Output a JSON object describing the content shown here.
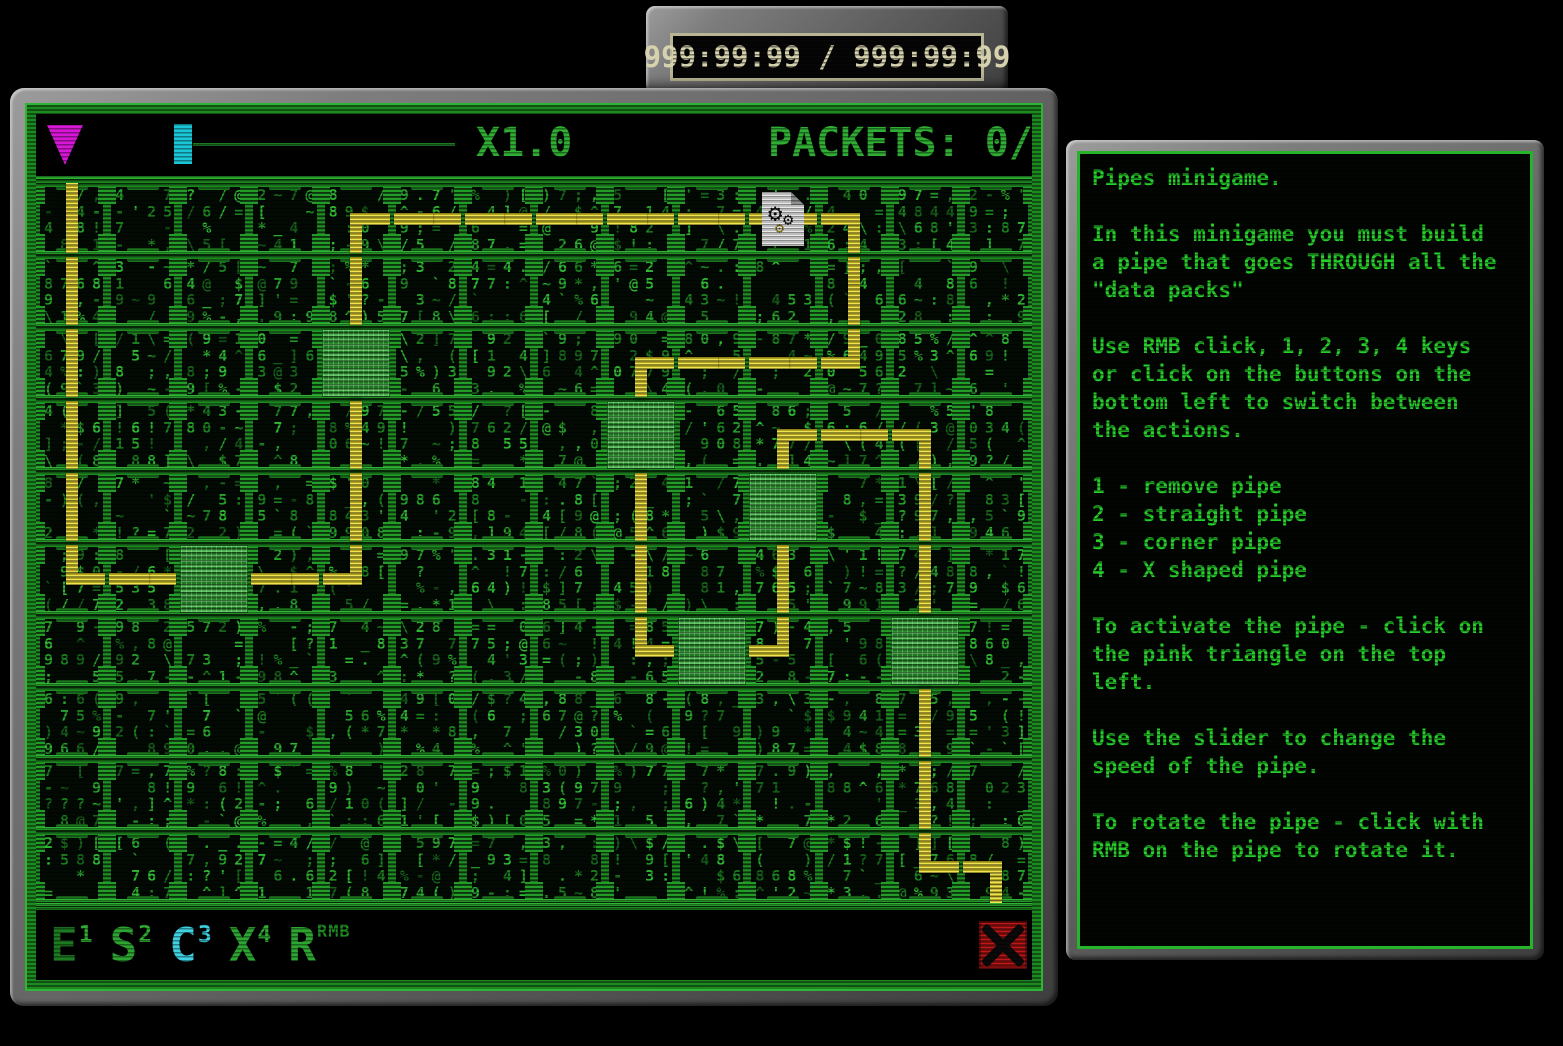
{
  "timer": {
    "display": "999:99:99 / 999:99:99"
  },
  "game": {
    "header": {
      "speed_label": "X1.0",
      "packets_label": "PACKETS: 0/"
    },
    "toolbar": {
      "buttons": [
        {
          "letter": "E",
          "hotkey": "1",
          "action": "remove pipe",
          "active": false,
          "color": "#1d7a21",
          "hotkey_color": "#2fae33"
        },
        {
          "letter": "S",
          "hotkey": "2",
          "action": "straight pipe",
          "active": false,
          "color": "#2da531",
          "hotkey_color": "#2fae33"
        },
        {
          "letter": "C",
          "hotkey": "3",
          "action": "corner pipe",
          "active": true,
          "color": "#3fd2e2",
          "hotkey_color": "#3fd2e2"
        },
        {
          "letter": "X",
          "hotkey": "4",
          "action": "X shaped pipe",
          "active": false,
          "color": "#2da531",
          "hotkey_color": "#2fae33"
        },
        {
          "letter": "R",
          "hotkey": "RMB",
          "action": "rotate pipe",
          "active": false,
          "color": "#2da531",
          "hotkey_color": "#1d8a21"
        }
      ]
    },
    "grid": {
      "cols": 14,
      "rows": 10,
      "glyph_seed": 1337,
      "glyph_charset": "0123456789998877654[];;,,--==//\\~^!?@$%*'`_:.()",
      "glyph_colors": [
        "#1c7f20",
        "#28a12c",
        "#17611b",
        "#2fb834"
      ],
      "pipe_segments": [
        {
          "c": 0,
          "r": 0,
          "t": "v"
        },
        {
          "c": 0,
          "r": 1,
          "t": "v"
        },
        {
          "c": 0,
          "r": 2,
          "t": "v"
        },
        {
          "c": 0,
          "r": 3,
          "t": "v"
        },
        {
          "c": 0,
          "r": 4,
          "t": "v"
        },
        {
          "c": 0,
          "r": 5,
          "t": "ne"
        },
        {
          "c": 1,
          "r": 5,
          "t": "h"
        },
        {
          "c": 2,
          "r": 5,
          "t": "h"
        },
        {
          "c": 3,
          "r": 5,
          "t": "h"
        },
        {
          "c": 4,
          "r": 5,
          "t": "nw"
        },
        {
          "c": 4,
          "r": 4,
          "t": "v"
        },
        {
          "c": 4,
          "r": 3,
          "t": "v"
        },
        {
          "c": 4,
          "r": 2,
          "t": "v"
        },
        {
          "c": 4,
          "r": 1,
          "t": "v"
        },
        {
          "c": 4,
          "r": 0,
          "t": "se"
        },
        {
          "c": 5,
          "r": 0,
          "t": "h"
        },
        {
          "c": 6,
          "r": 0,
          "t": "h"
        },
        {
          "c": 7,
          "r": 0,
          "t": "h"
        },
        {
          "c": 8,
          "r": 0,
          "t": "h"
        },
        {
          "c": 9,
          "r": 0,
          "t": "h"
        },
        {
          "c": 10,
          "r": 0,
          "t": "h"
        },
        {
          "c": 11,
          "r": 0,
          "t": "sw"
        },
        {
          "c": 11,
          "r": 1,
          "t": "v"
        },
        {
          "c": 11,
          "r": 2,
          "t": "nw"
        },
        {
          "c": 10,
          "r": 2,
          "t": "h"
        },
        {
          "c": 9,
          "r": 2,
          "t": "h"
        },
        {
          "c": 8,
          "r": 2,
          "t": "se"
        },
        {
          "c": 8,
          "r": 3,
          "t": "v"
        },
        {
          "c": 8,
          "r": 4,
          "t": "v"
        },
        {
          "c": 8,
          "r": 5,
          "t": "v"
        },
        {
          "c": 8,
          "r": 6,
          "t": "ne"
        },
        {
          "c": 9,
          "r": 6,
          "t": "h"
        },
        {
          "c": 10,
          "r": 6,
          "t": "nw"
        },
        {
          "c": 10,
          "r": 5,
          "t": "v"
        },
        {
          "c": 10,
          "r": 4,
          "t": "v"
        },
        {
          "c": 10,
          "r": 3,
          "t": "se"
        },
        {
          "c": 11,
          "r": 3,
          "t": "h"
        },
        {
          "c": 12,
          "r": 3,
          "t": "sw"
        },
        {
          "c": 12,
          "r": 4,
          "t": "v"
        },
        {
          "c": 12,
          "r": 5,
          "t": "v"
        },
        {
          "c": 12,
          "r": 6,
          "t": "v"
        },
        {
          "c": 12,
          "r": 7,
          "t": "v"
        },
        {
          "c": 12,
          "r": 8,
          "t": "v"
        },
        {
          "c": 12,
          "r": 9,
          "t": "ne"
        },
        {
          "c": 13,
          "r": 9,
          "t": "sw"
        }
      ],
      "data_packs": [
        [
          2,
          5
        ],
        [
          4,
          2
        ],
        [
          8,
          3
        ],
        [
          10,
          4
        ],
        [
          9,
          6
        ],
        [
          12,
          6
        ]
      ],
      "document_cell": [
        10,
        0
      ]
    }
  },
  "help": {
    "text": "Pipes minigame.\n\nIn this minigame you must build\na pipe that goes THROUGH all the\n\"data packs\"\n\nUse RMB click, 1, 2, 3, 4 keys\nor click on the buttons on the\nbottom left to switch between\nthe actions.\n\n1 - remove pipe\n2 - straight pipe\n3 - corner pipe\n4 - X shaped pipe\n\nTo activate the pipe - click on\nthe pink triangle on the top\nleft.\n\nUse the slider to change the\nspeed of the pipe.\n\nTo rotate the pipe - click with\nRMB on the pipe to rotate it."
  },
  "colors": {
    "pipe_bright": "#ece452",
    "pipe_dark": "#b3a21f",
    "border_green": "#2fb433",
    "dim_green": "#1d8a21",
    "data_pack": "#2f9e33",
    "play_pink": "#d617d6",
    "slider_cyan": "#1ac6d6",
    "active_tool_cyan": "#3fd2e2",
    "close_red": "#b51414",
    "help_text_green": "#27cf2b",
    "timer_text": "#d6d2ae"
  }
}
